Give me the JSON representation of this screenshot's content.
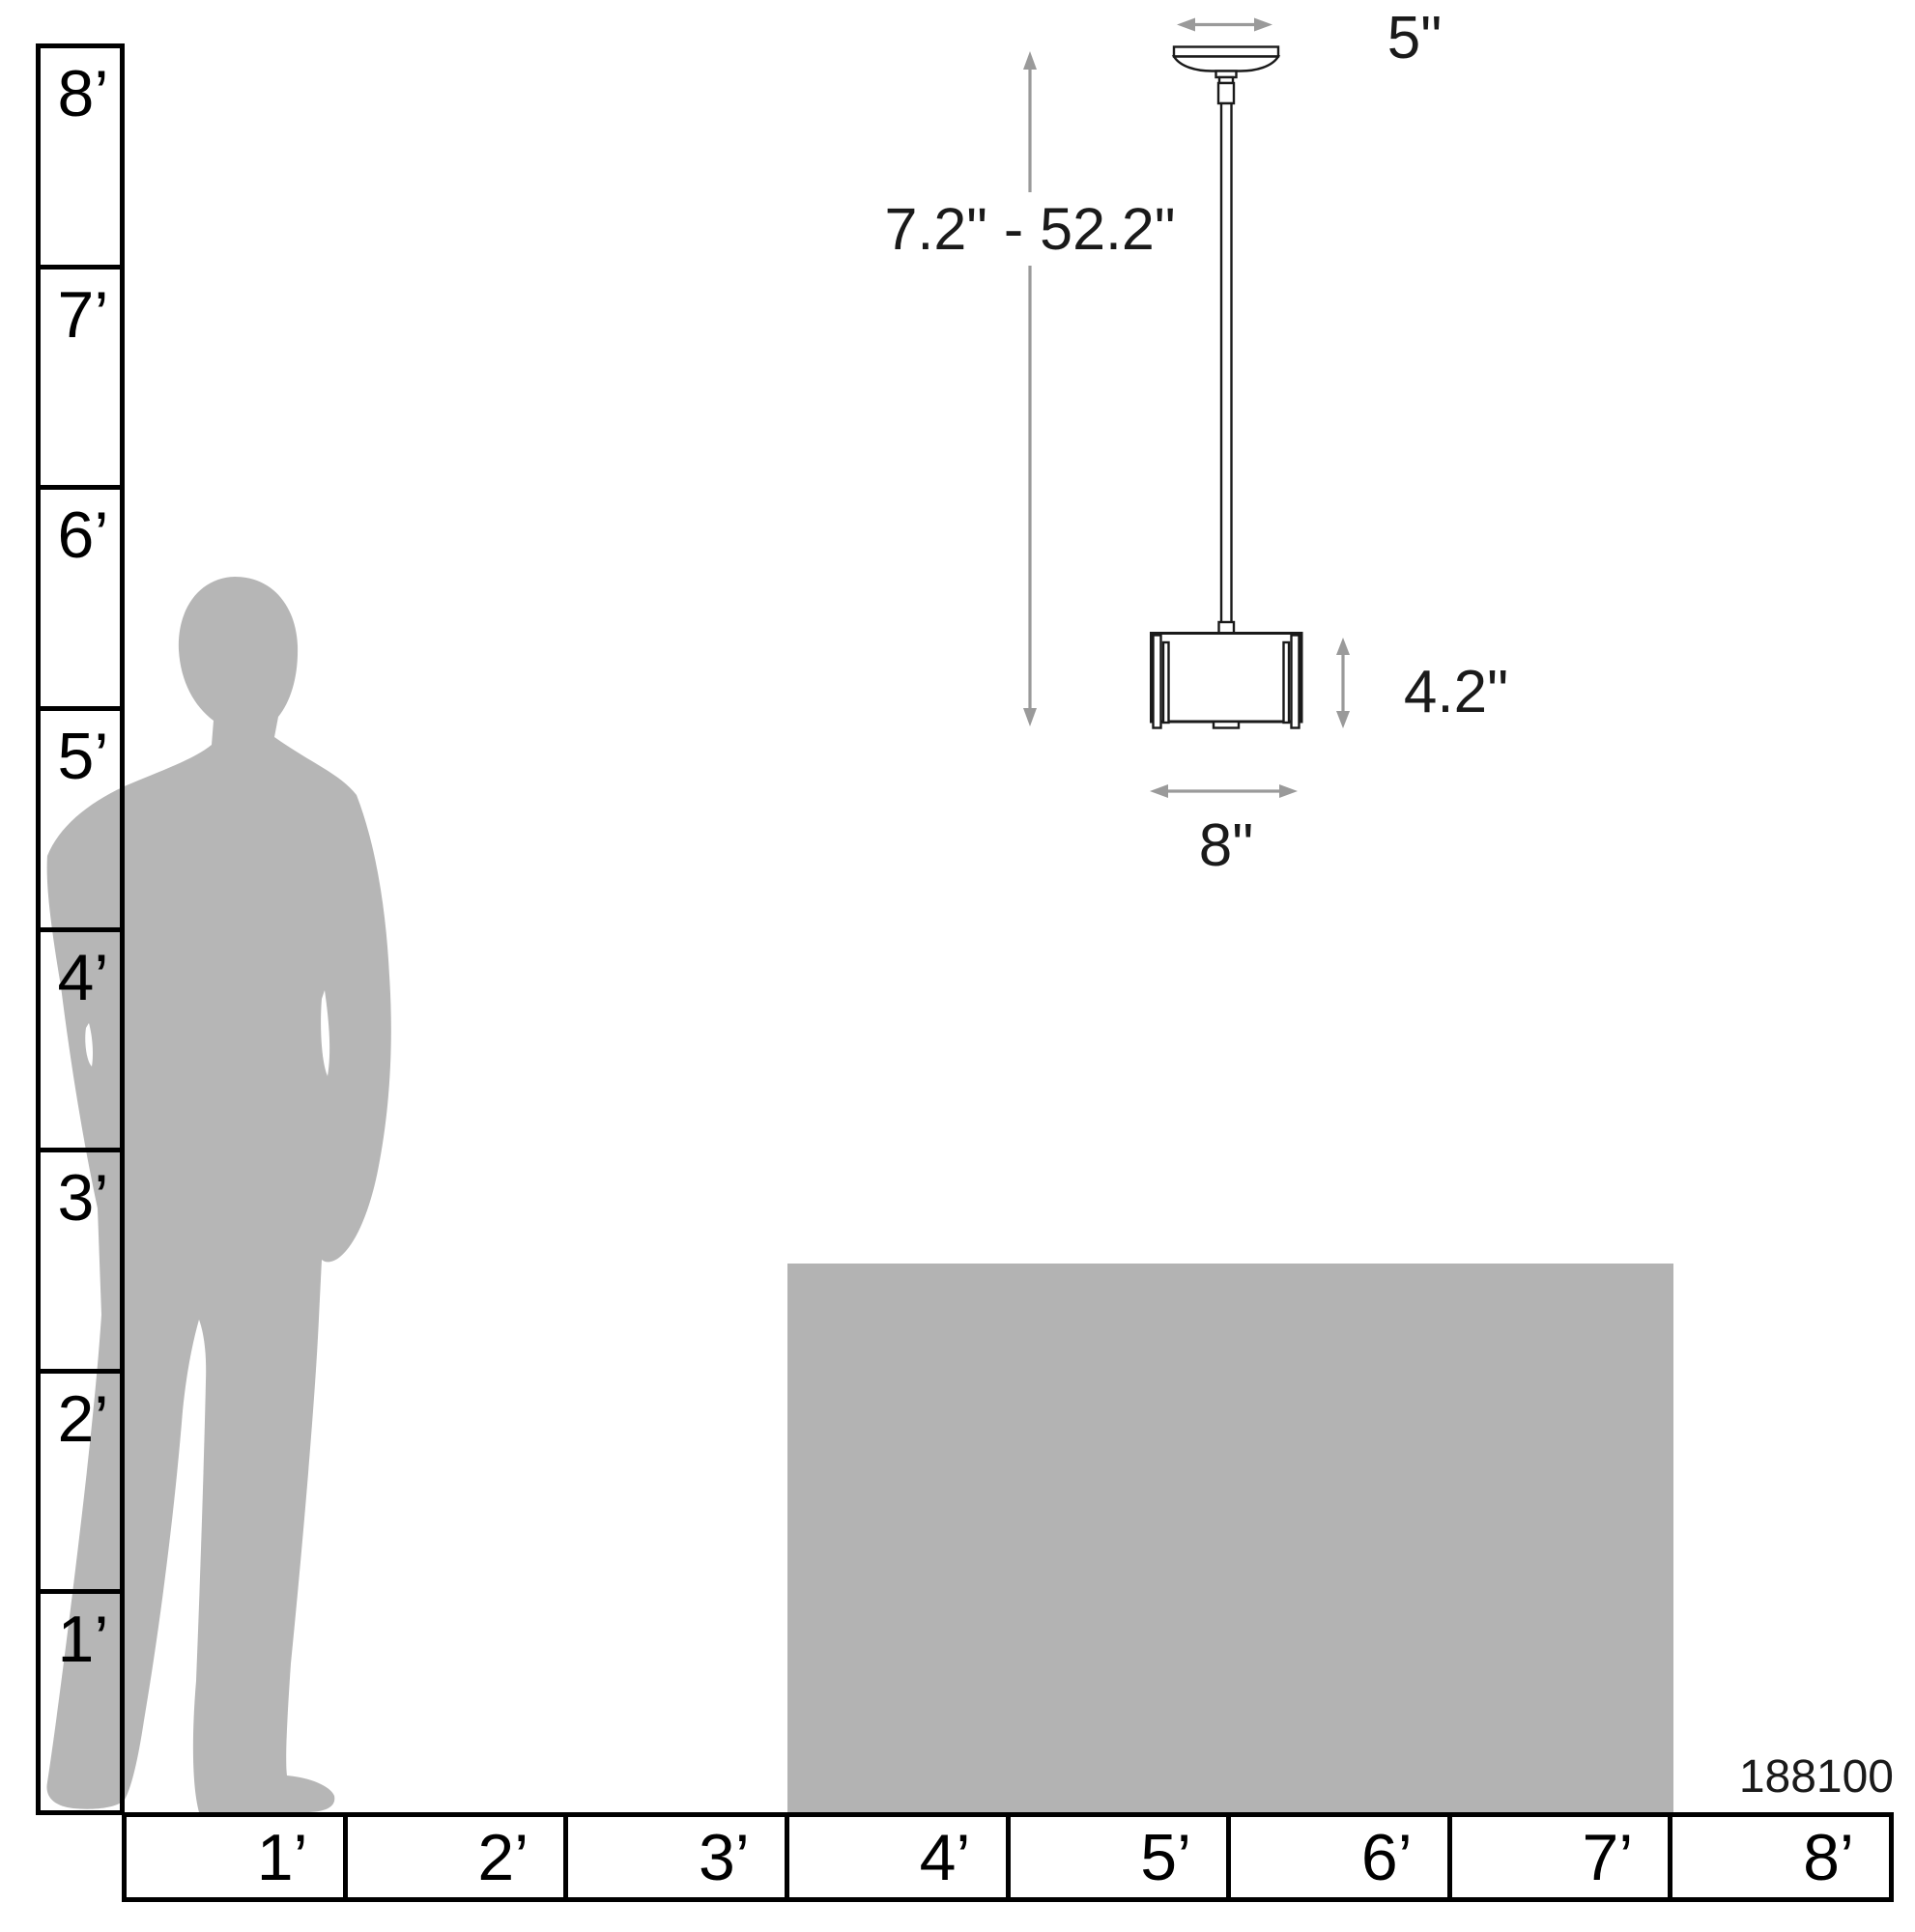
{
  "diagram": {
    "title": "Pendant light scale dimension diagram",
    "product_number": "188100",
    "dimensions": {
      "canopy_width": "5\"",
      "height_range": "7.2\" - 52.2\"",
      "shade_height": "4.2\"",
      "shade_width": "8\""
    },
    "vertical_ruler": {
      "unit": "feet",
      "labels": [
        "8’",
        "7’",
        "6’",
        "5’",
        "4’",
        "3’",
        "2’",
        "1’"
      ]
    },
    "horizontal_ruler": {
      "unit": "feet",
      "labels": [
        "1’",
        "2’",
        "3’",
        "4’",
        "5’",
        "6’",
        "7’",
        "8’"
      ]
    }
  },
  "colors": {
    "background": "#ffffff",
    "line": "#1a1a1a",
    "rulerline": "#000000",
    "arrow": "#9a9a9a",
    "silhouette": "#b6b6b6",
    "tablefill": "#b3b3b3"
  }
}
